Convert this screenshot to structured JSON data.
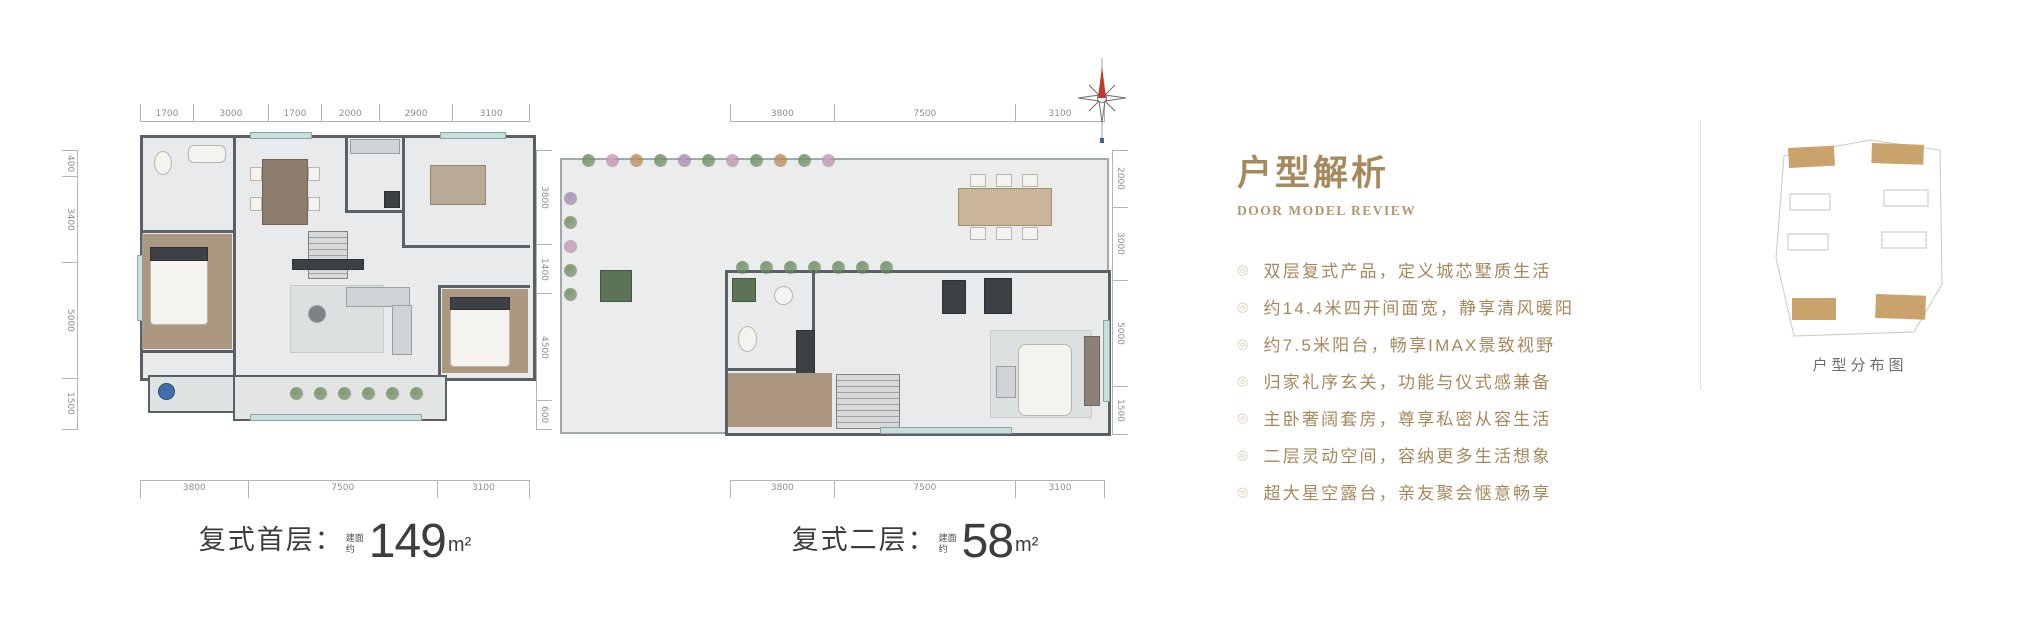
{
  "floor_plans": [
    {
      "caption_prefix": "复式首层：",
      "area_qualifier": "建面约",
      "area_value": "149",
      "area_unit": "m²",
      "dims": {
        "top": [
          "1700",
          "3000",
          "1700",
          "2000",
          "2900",
          "3100"
        ],
        "bottom": [
          "3800",
          "7500",
          "3100"
        ],
        "left": [
          "400",
          "3400",
          "5000",
          "1500"
        ],
        "right": [
          "3800",
          "1400",
          "4500",
          "600"
        ]
      }
    },
    {
      "caption_prefix": "复式二层：",
      "area_qualifier": "建面约",
      "area_value": "58",
      "area_unit": "m²",
      "dims": {
        "top": [
          "3800",
          "7500",
          "3100"
        ],
        "bottom": [
          "3800",
          "7500",
          "3100"
        ],
        "right": [
          "2000",
          "3000",
          "5000",
          "1500"
        ]
      }
    }
  ],
  "analysis": {
    "title": "户型解析",
    "subtitle": "DOOR MODEL REVIEW",
    "bullet_icon": "◎",
    "bullets": [
      "双层复式产品，定义城芯墅质生活",
      "约14.4米四开间面宽，静享清风暖阳",
      "约7.5米阳台，畅享IMAX景致视野",
      "归家礼序玄关，功能与仪式感兼备",
      "主卧奢阔套房，尊享私密从容生活",
      "二层灵动空间，容纳更多生活想象",
      "超大星空露台，亲友聚会惬意畅享"
    ]
  },
  "site_map": {
    "caption": "户型分布图",
    "highlight_color": "#c9a36b",
    "outline_color": "#c9c9c9",
    "buildings": [
      {
        "x": 16,
        "y": 12,
        "w": 46,
        "h": 20,
        "filled": true,
        "rot": -3
      },
      {
        "x": 100,
        "y": 7,
        "w": 52,
        "h": 20,
        "filled": true,
        "rot": 2
      },
      {
        "x": 18,
        "y": 58,
        "w": 40,
        "h": 16,
        "filled": false,
        "rot": 0
      },
      {
        "x": 112,
        "y": 54,
        "w": 44,
        "h": 16,
        "filled": false,
        "rot": 0
      },
      {
        "x": 16,
        "y": 98,
        "w": 40,
        "h": 16,
        "filled": false,
        "rot": 0
      },
      {
        "x": 110,
        "y": 96,
        "w": 44,
        "h": 16,
        "filled": false,
        "rot": 0
      },
      {
        "x": 20,
        "y": 162,
        "w": 44,
        "h": 22,
        "filled": true,
        "rot": 0
      },
      {
        "x": 104,
        "y": 158,
        "w": 50,
        "h": 24,
        "filled": true,
        "rot": 2
      }
    ]
  },
  "plant_colors": {
    "green": "#7d9c6f",
    "pink": "#d4a6c2",
    "orange": "#c79a5f",
    "purple": "#b39ac4"
  }
}
